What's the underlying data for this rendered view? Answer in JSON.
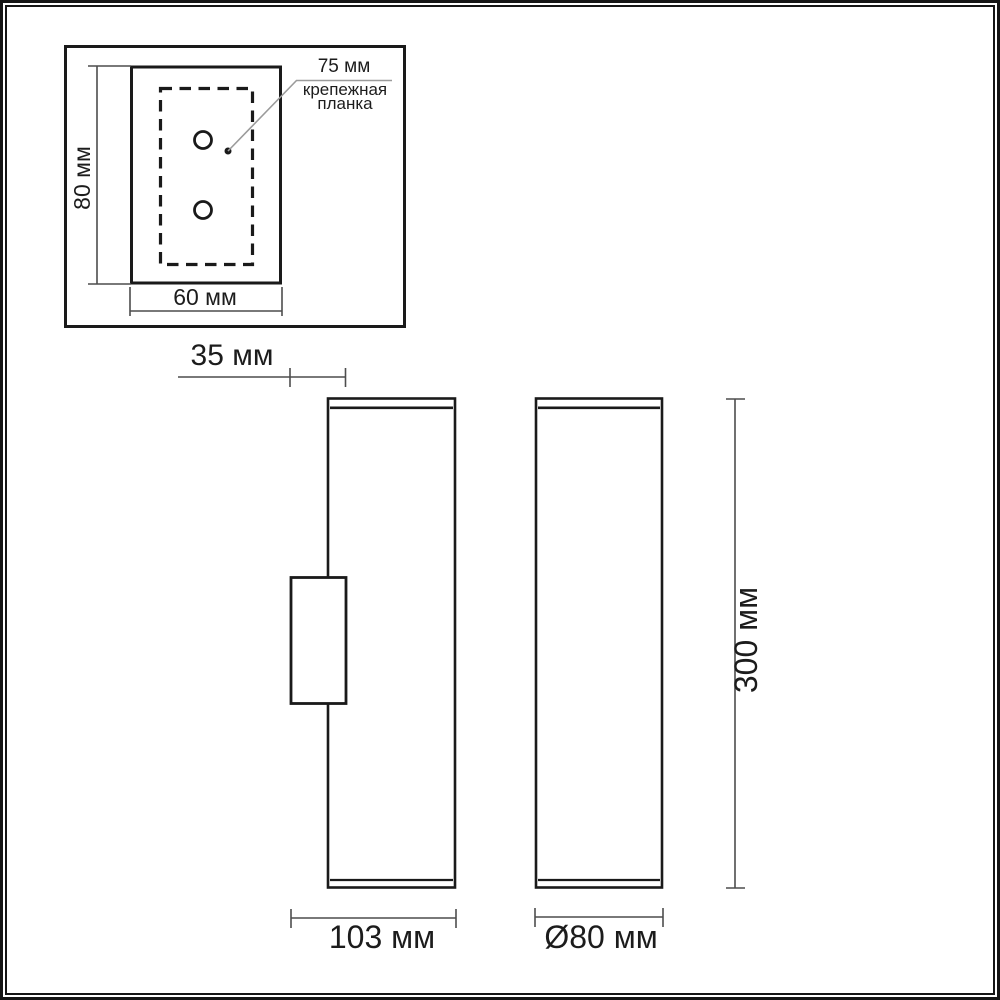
{
  "detail_inset": {
    "height_label": "80 мм",
    "width_label": "60 мм",
    "spacing_label": "75 мм",
    "part_label_line1": "крепежная",
    "part_label_line2": "планка"
  },
  "side_view": {
    "bracket_depth_label": "35 мм",
    "total_depth_label": "103 мм"
  },
  "front_view": {
    "height_label": "300 мм",
    "diameter_label": "Ø80 мм"
  },
  "colors": {
    "outline": "#1a1a1a",
    "dimension_line": "#4d4d4d",
    "leader_line": "#9b9b9b",
    "background": "#ffffff"
  }
}
